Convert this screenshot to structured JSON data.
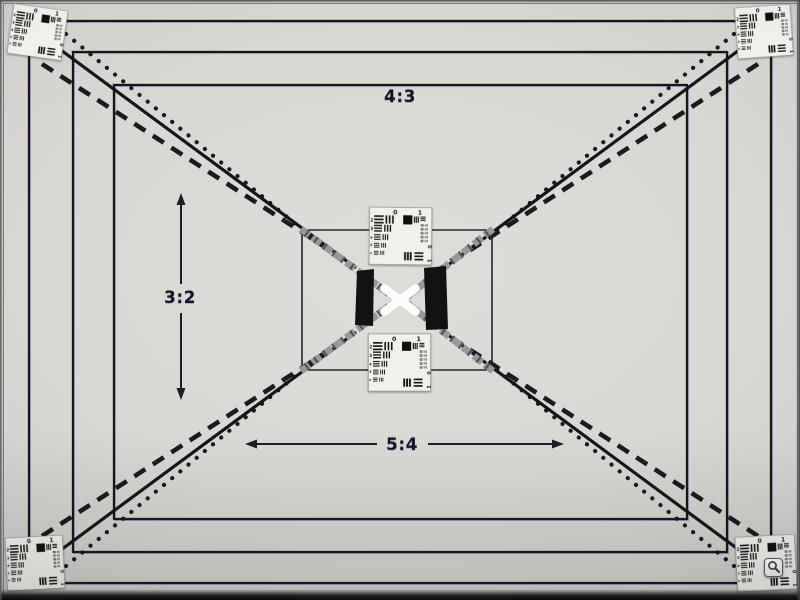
{
  "labels": {
    "aspect_4_3": "4:3",
    "aspect_3_2": "3:2",
    "aspect_5_4": "5:4"
  },
  "usaf_target": {
    "top_group_labels": {
      "zero": "0",
      "one": "1"
    },
    "element_numbers": [
      "2",
      "3",
      "4",
      "5",
      "6"
    ],
    "side_labels": {
      "zero": "0",
      "one": "1"
    }
  },
  "controls": {
    "zoom_button": {
      "icon": "magnifier-icon"
    }
  },
  "colors": {
    "background_center": "#dcdbd7",
    "background_edge": "#979694",
    "line": "#16161e",
    "fringe_yellow": "#b2a84a",
    "fringe_blue": "#4553a8",
    "card_background": "#f1f0ec",
    "bars": "#161614",
    "black_block": "#121212",
    "band_gray": "#98979b",
    "x_mark": "#fcfcfa"
  }
}
